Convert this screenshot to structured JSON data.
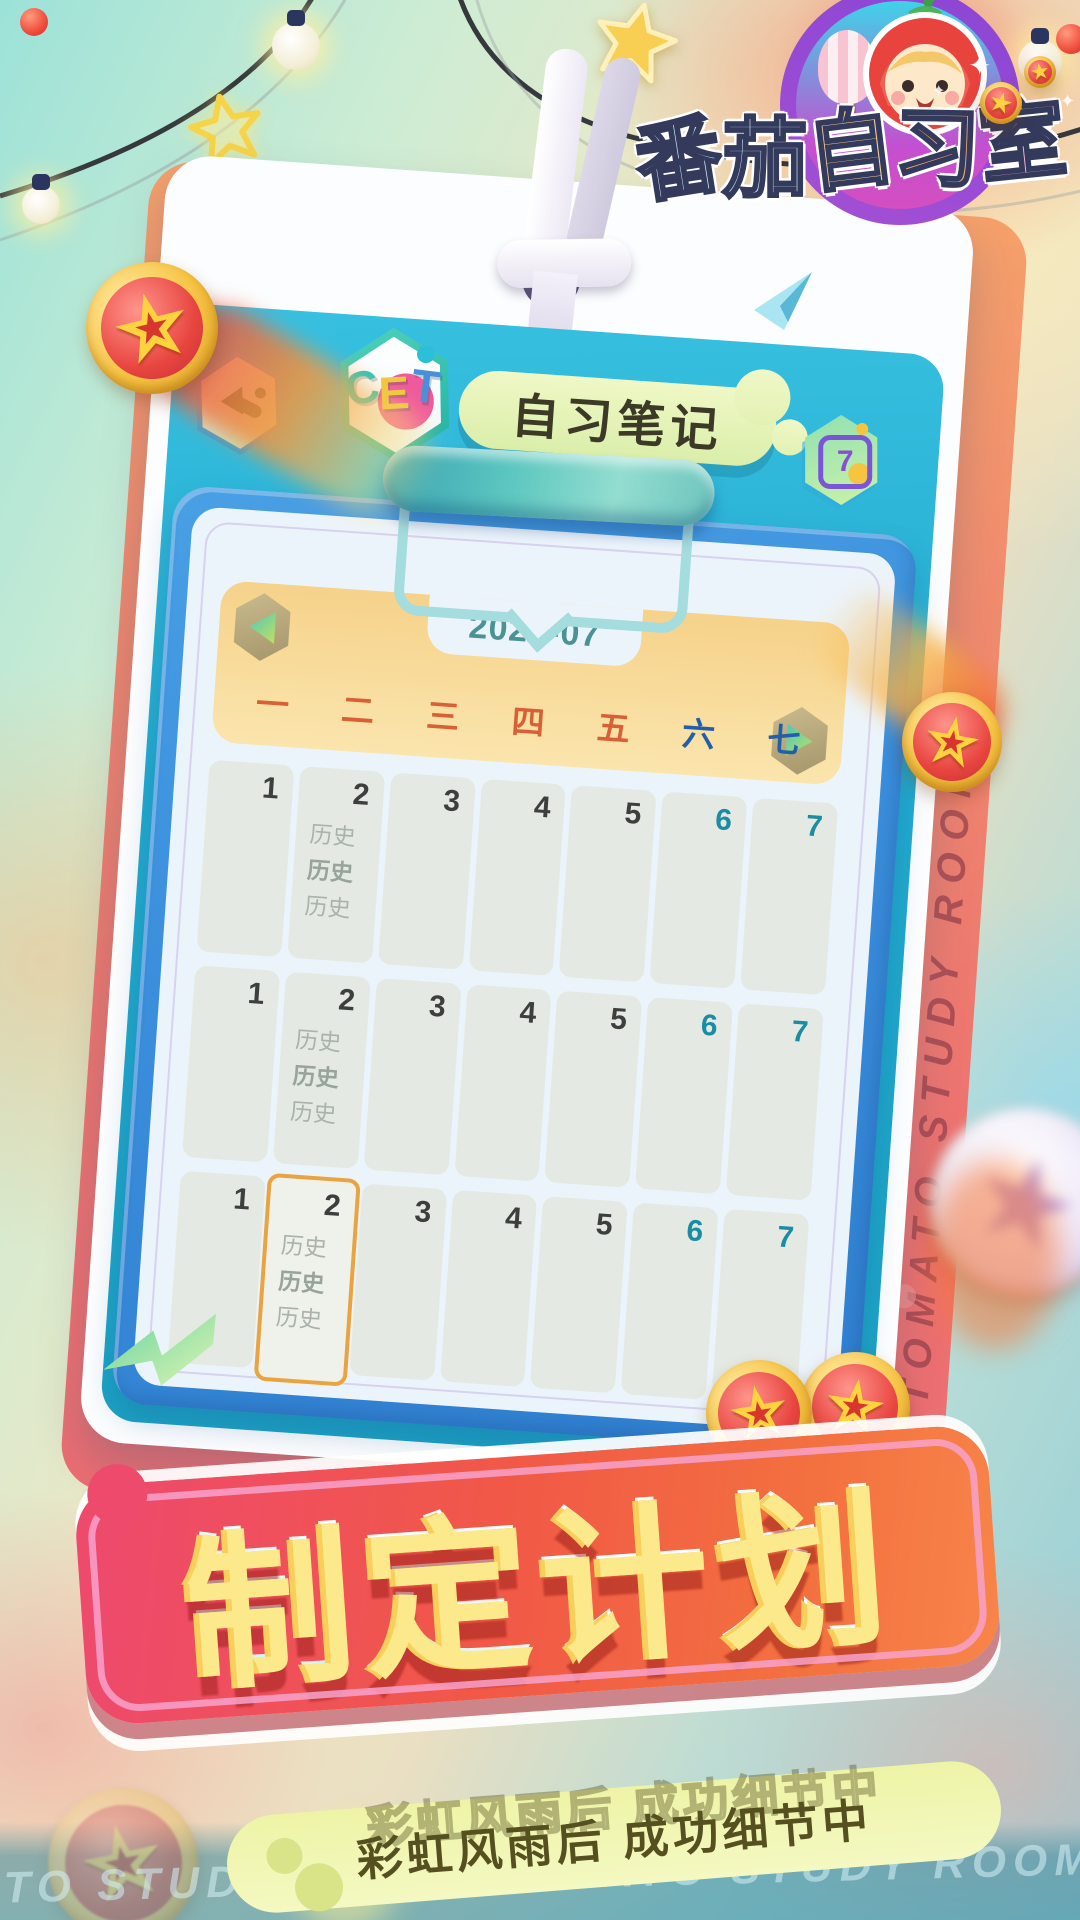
{
  "logo": {
    "text": "番茄自习室",
    "chars": [
      "番",
      "茄",
      "自",
      "习",
      "室"
    ]
  },
  "header": {
    "exam_badge": "CET",
    "badge_chars": [
      "C",
      "E",
      "T"
    ],
    "title": "自习笔记",
    "calendar_icon_day": "7"
  },
  "calendar": {
    "month": "2022-07",
    "weekdays": [
      "一",
      "二",
      "三",
      "四",
      "五",
      "六",
      "七"
    ],
    "rows": [
      {
        "cells": [
          {
            "date": "1"
          },
          {
            "date": "2",
            "entries": [
              "历史",
              "历史",
              "历史"
            ]
          },
          {
            "date": "3"
          },
          {
            "date": "4"
          },
          {
            "date": "5"
          },
          {
            "date": "6"
          },
          {
            "date": "7"
          }
        ]
      },
      {
        "cells": [
          {
            "date": "1"
          },
          {
            "date": "2",
            "entries": [
              "历史",
              "历史",
              "历史"
            ]
          },
          {
            "date": "3"
          },
          {
            "date": "4"
          },
          {
            "date": "5"
          },
          {
            "date": "6"
          },
          {
            "date": "7"
          }
        ]
      },
      {
        "cells": [
          {
            "date": "1"
          },
          {
            "date": "2",
            "entries": [
              "历史",
              "历史",
              "历史"
            ],
            "highlighted": true
          },
          {
            "date": "3"
          },
          {
            "date": "4"
          },
          {
            "date": "5"
          },
          {
            "date": "6"
          },
          {
            "date": "7"
          }
        ]
      }
    ]
  },
  "banner": {
    "title": "制定计划"
  },
  "slogan": {
    "text": "彩虹风雨后  成功细节中"
  },
  "watermarks": {
    "vertical": "TOMATO STUDY ROOM",
    "bottom": "TOMATO STUDY ROOM TOMATO STUDY ROOM"
  },
  "decor": {
    "star_glyph": "★",
    "sparkle_glyph": "✦"
  },
  "colors": {
    "banner_red": "#ee4a6b",
    "banner_orange": "#f3703f",
    "clipboard_blue": "#3b8fdc",
    "card_teal": "#22abcf",
    "weekday_workday": "#d85f36",
    "weekday_weekend": "#235fa8",
    "date_weekend": "#1b8ca2",
    "highlight_border": "#eaa33f",
    "pill_green": "#eef4a6"
  }
}
